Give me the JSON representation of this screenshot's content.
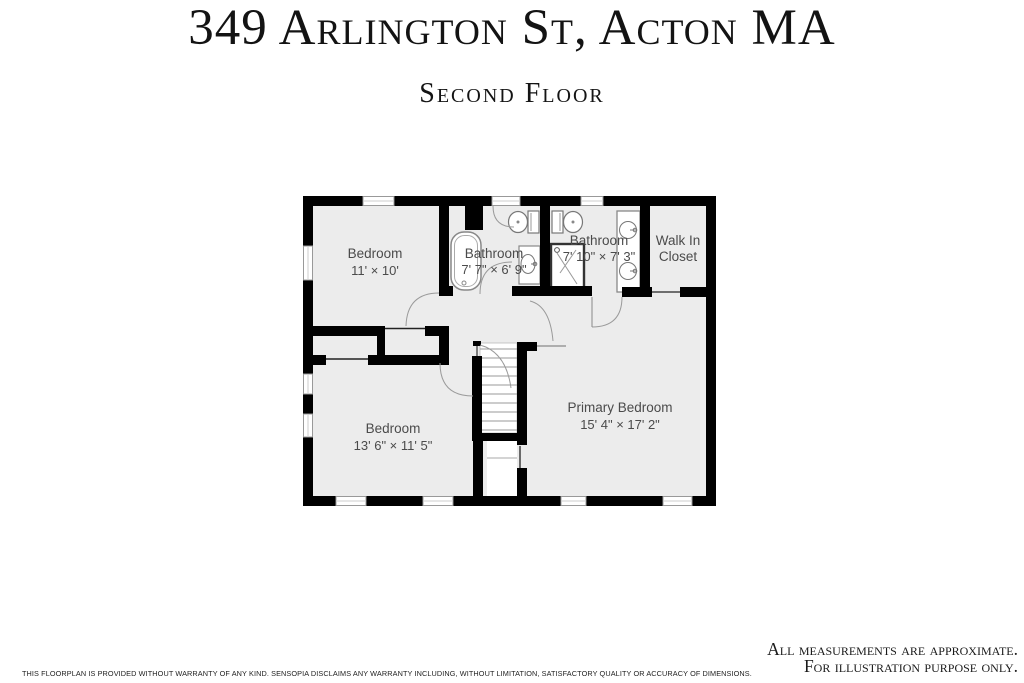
{
  "title": "349 Arlington St, Acton MA",
  "subtitle": "Second Floor",
  "rooms": [
    {
      "id": "bedroom-1",
      "line1": "Bedroom",
      "line2": "11' × 10'"
    },
    {
      "id": "bathroom-1",
      "line1": "Bathroom",
      "line2": "7' 7\" × 6' 9\""
    },
    {
      "id": "bathroom-2",
      "line1": "Bathroom",
      "line2": "7' 10\" × 7' 3\""
    },
    {
      "id": "walk-in-closet",
      "line1": "Walk In",
      "line2": "Closet"
    },
    {
      "id": "bedroom-2",
      "line1": "Bedroom",
      "line2": "13' 6\" × 11' 5\""
    },
    {
      "id": "primary-bedroom",
      "line1": "Primary Bedroom",
      "line2": "15' 4\" × 17' 2\""
    }
  ],
  "fixtures": [
    "bathtub",
    "toilet",
    "toilet",
    "sink-vanity",
    "shower",
    "double-vanity",
    "staircase"
  ],
  "footer": {
    "note_line1": "All measurements are approximate.",
    "note_line2": "For illustration purpose only.",
    "disclaimer": "THIS FLOORPLAN IS PROVIDED WITHOUT WARRANTY OF ANY KIND. SENSOPIA DISCLAIMS ANY WARRANTY INCLUDING, WITHOUT LIMITATION, SATISFACTORY QUALITY OR ACCURACY OF DIMENSIONS."
  },
  "colors": {
    "wall": "#000000",
    "floor": "#ececec",
    "fixture_stroke": "#888888",
    "door_arc": "#9a9a9a",
    "label_text": "#4b4b4b",
    "background": "#ffffff"
  }
}
